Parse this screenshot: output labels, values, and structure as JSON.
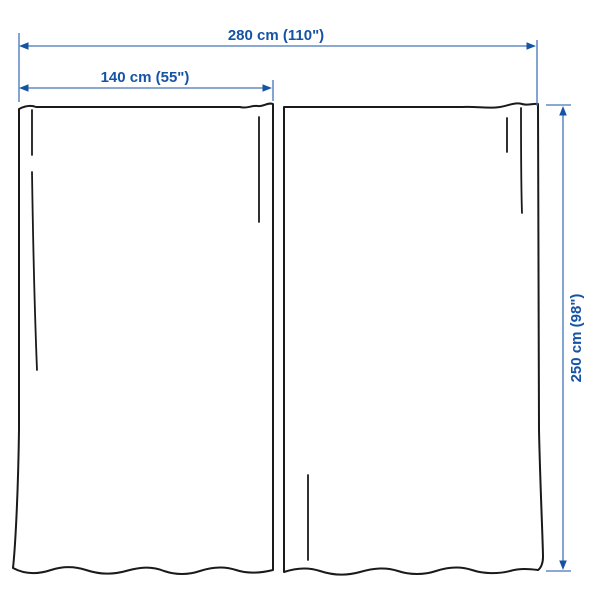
{
  "diagram": {
    "type": "product-dimensions",
    "subject": "curtain-pair",
    "labels": {
      "total_width": "280 cm (110\")",
      "panel_width": "140 cm (55\")",
      "height": "250 cm (98\")"
    },
    "measurements": {
      "total_width_cm": 280,
      "total_width_in": 110,
      "panel_width_cm": 140,
      "panel_width_in": 55,
      "height_cm": 250,
      "height_in": 98
    },
    "colors": {
      "dimension_text": "#1553a5",
      "dimension_line": "#4574b8",
      "arrowhead": "#1553a5",
      "curtain_outline": "#1a1a1a",
      "background": "#ffffff"
    }
  }
}
